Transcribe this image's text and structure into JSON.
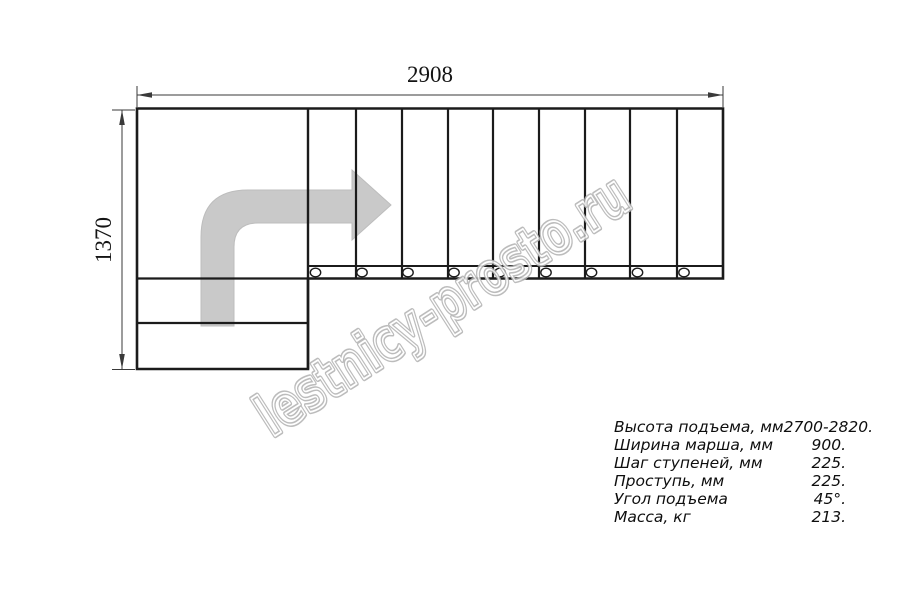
{
  "title": "Staircase plan drawing",
  "dimensions": {
    "width_mm": "2908",
    "height_mm": "1370"
  },
  "watermark": {
    "text": "lestnicy-prosto.ru"
  },
  "specs": {
    "rows": [
      {
        "label": "Высота подъема, мм",
        "value": "2700-2820."
      },
      {
        "label": "Ширина марша, мм",
        "value": "900."
      },
      {
        "label": "Шаг ступеней, мм",
        "value": "225."
      },
      {
        "label": "Проступь, мм",
        "value": "225."
      },
      {
        "label": "Угол подъема",
        "value": "45°."
      },
      {
        "label": "Масса, кг",
        "value": "213."
      }
    ]
  },
  "colors": {
    "drawing_line": "#1b1b1b",
    "dimension_line": "#3a3a3a",
    "arrow_fill": "#c9c9c9",
    "watermark_outline": "#b3b3b3"
  }
}
